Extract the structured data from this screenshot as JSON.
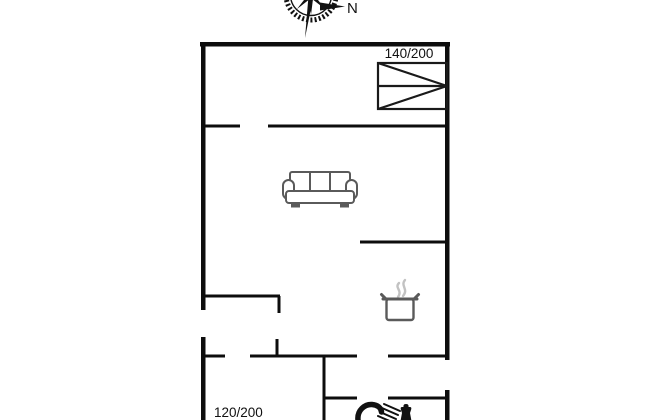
{
  "compass": {
    "north_label": "N",
    "icon": "compass-rose-icon"
  },
  "beds": {
    "top_right_label": "140/200",
    "bottom_left_label": "120/200"
  },
  "icons": {
    "bed_symbol": "double-bed-symbol",
    "sofa": "sofa-icon",
    "pot": "cooking-pot-icon",
    "shower": "shower-icon",
    "toilet": "toilet-icon"
  },
  "colors": {
    "wall": "#0d0d0d",
    "bed_outline": "#1a1a1a",
    "furniture": "#5a5a5a",
    "steam": "#c2c2c2",
    "black_icon": "#111111",
    "text": "#111111",
    "background": "#ffffff"
  }
}
